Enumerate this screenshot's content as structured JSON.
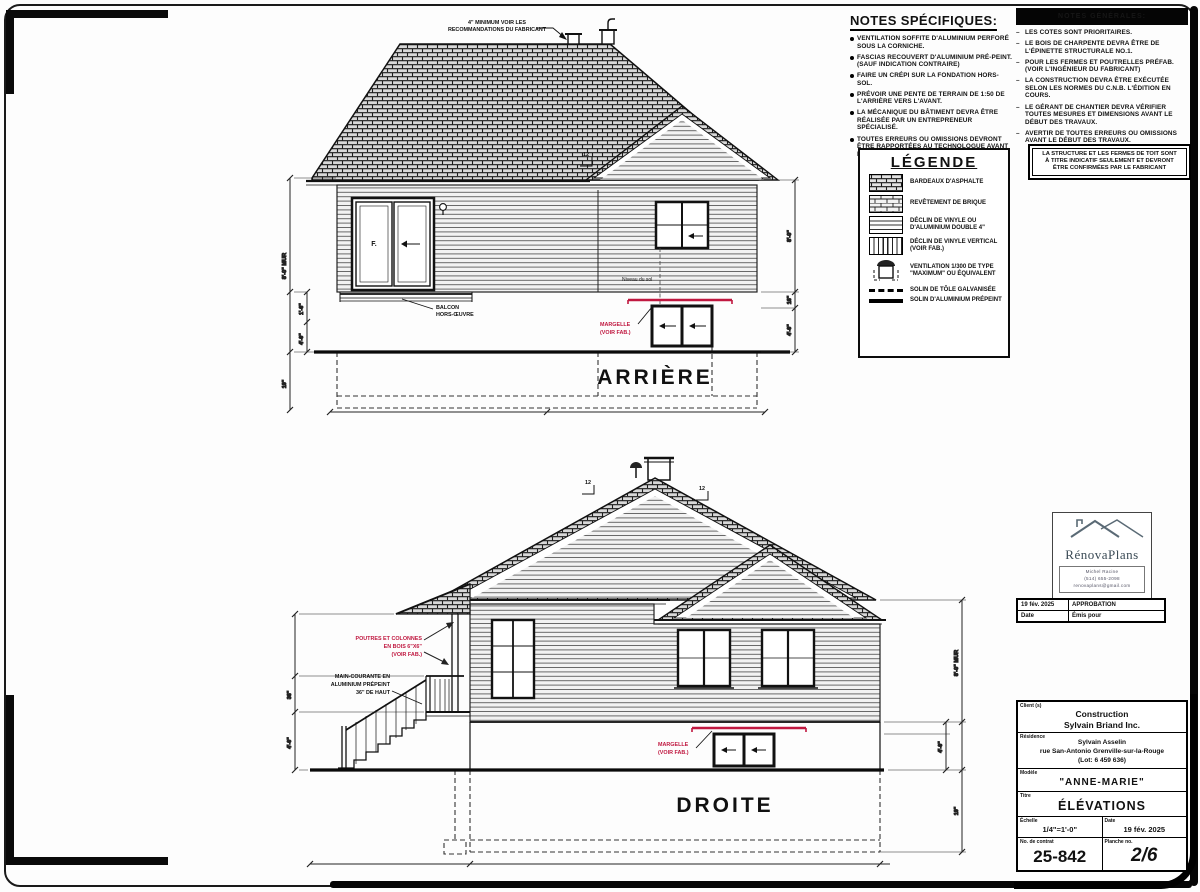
{
  "notes_specifiques": {
    "title": "NOTES SPÉCIFIQUES:",
    "items": [
      "VENTILATION SOFFITE D'ALUMINIUM PERFORÉ SOUS LA CORNICHE.",
      "FASCIAS RECOUVERT D'ALUMINIUM PRÉ-PEINT. (SAUF INDICATION CONTRAIRE)",
      "FAIRE UN CRÉPI SUR LA FONDATION HORS-SOL.",
      "PRÉVOIR UNE PENTE DE TERRAIN DE 1:50 DE L'ARRIÈRE VERS L'AVANT.",
      "LA MÉCANIQUE DU BÂTIMENT DEVRA ÊTRE RÉALISÉE PAR UN ENTREPRENEUR SPÉCIALISÉ.",
      "TOUTES ERREURS OU OMISSIONS DEVRONT ÊTRE RAPPORTÉES AU TECHNOLOGUE AVANT LA MISE EN CHANTIER."
    ]
  },
  "notes_generales": {
    "header": "NOTES GÉNÉRALES:",
    "items": [
      "LES COTES SONT PRIORITAIRES.",
      "LE BOIS DE CHARPENTE DEVRA ÊTRE DE L'ÉPINETTE STRUCTURALE NO.1.",
      "POUR LES FERMES ET POUTRELLES PRÉFAB. (VOIR L'INGÉNIEUR DU FABRICANT)",
      "LA CONSTRUCTION DEVRA ÊTRE EXÉCUTÉE SELON LES NORMES DU C.N.B. L'ÉDITION EN COURS.",
      "LE GÉRANT DE CHANTIER DEVRA VÉRIFIER TOUTES MESURES ET DIMENSIONS AVANT LE DÉBUT DES TRAVAUX.",
      "AVERTIR DE TOUTES ERREURS OU OMISSIONS AVANT LE DÉBUT DES TRAVAUX."
    ],
    "boxed_note_lines": [
      "LA STRUCTURE ET LES FERMES DE TOIT SONT",
      "À TITRE INDICATIF SEULEMENT ET DEVRONT",
      "ÊTRE CONFIRMÉES PAR LE FABRICANT"
    ]
  },
  "legende": {
    "title": "LÉGENDE",
    "items": [
      {
        "icon": "shingle-swatch",
        "label": "BARDEAUX D'ASPHALTE"
      },
      {
        "icon": "brick-swatch",
        "label": "REVÊTEMENT DE BRIQUE"
      },
      {
        "icon": "horizontal-siding-swatch",
        "label": "DÉCLIN DE VINYLE OU D'ALUMINIUM DOUBLE 4\""
      },
      {
        "icon": "vertical-siding-swatch",
        "label": "DÉCLIN DE VINYLE VERTICAL (VOIR FAB.)"
      },
      {
        "icon": "roof-vent-swatch",
        "label": "VENTILATION 1/300 DE TYPE \"MAXIMUM\" OU ÉQUIVALENT"
      },
      {
        "icon": "dashed-line-swatch",
        "label": "SOLIN DE TÔLE GALVANISÉE"
      },
      {
        "icon": "solid-line-swatch",
        "label": "SOLIN D'ALUMINIUM PRÉPEINT"
      }
    ]
  },
  "rear": {
    "label": "ARRIÈRE",
    "vent_note_lines": [
      "4\" MINIMUM VOIR LES",
      "RECOMMANDATIONS DU FABRICANT"
    ],
    "balcony_lines": [
      "BALCON",
      "HORS-ŒUVRE"
    ],
    "door_label": "F.",
    "ground_label": "Niveau du sol",
    "margelle_lines": [
      "MARGELLE",
      "(VOIR FAB.)"
    ],
    "slope": "12",
    "dims": {
      "wall": "8'-0\" MUR",
      "a": "1'-6\"",
      "b": "4'-0\"",
      "c": "10\"",
      "d": "8'-0\"",
      "e": "16\"",
      "f": "4'-0\""
    }
  },
  "right_elev": {
    "label": "DROITE",
    "posts_lines": [
      "POUTRES ET COLONNES",
      "EN BOIS 6\"X6\"",
      "(VOIR FAB.)"
    ],
    "handrail_lines": [
      "MAIN-COURANTE EN",
      "ALUMINIUM PRÉPEINT",
      "36\" DE HAUT"
    ],
    "margelle_lines": [
      "MARGELLE",
      "(VOIR FAB.)"
    ],
    "slope": "12",
    "dims": {
      "wall": "8'-0\" MUR",
      "a": "4'-0\"",
      "b": "36\"",
      "c": "10\"",
      "d": "4'-0\""
    }
  },
  "logo": {
    "brand": "RénovaPlans",
    "contact_lines": [
      "Michel Racine",
      "(514) 655-2098",
      "renovaplans@gmail.com"
    ]
  },
  "revisions": {
    "row_date": "19 fév. 2025",
    "row_label": "APPROBATION",
    "header_date": "Date",
    "header_label": "Émis pour"
  },
  "title_block": {
    "client_label": "Client (s)",
    "client_lines": [
      "Construction",
      "Sylvain Briand Inc."
    ],
    "residence_label": "Résidence",
    "residence_lines": [
      "Sylvain Asselin",
      "rue San-Antonio Grenville-sur-la-Rouge",
      "(Lot: 6 459 636)"
    ],
    "modele_label": "Modèle",
    "modele_value": "\"ANNE-MARIE\"",
    "titre_label": "Titre",
    "titre_value": "ÉLÉVATIONS",
    "echelle_label": "Échelle",
    "echelle_value": "1/4\"=1'-0\"",
    "date_label": "Date",
    "date_value": "19 fév. 2025",
    "contrat_label": "No. de contrat",
    "contrat_value": "25-842",
    "planche_label": "Planche no.",
    "planche_value": "2/6"
  },
  "colors": {
    "accent_red": "#c01840",
    "ink": "#111111"
  }
}
